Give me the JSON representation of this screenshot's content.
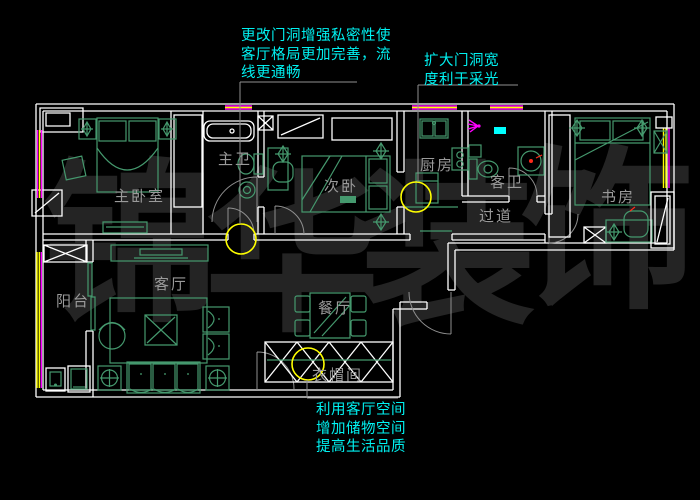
{
  "colors": {
    "background": "#000000",
    "wall": "#ffffff",
    "furniture": "#45996e",
    "annotation": "#00f2f2",
    "label": "#9a9a9a",
    "window_yellow": "#ffff00",
    "window_magenta": "#ff00ff",
    "highlight": "#ffff00",
    "watermark": "#242424",
    "door_arc": "#8f8f8f",
    "accent_red": "#ff2a1a",
    "accent_cyan": "#00ffff"
  },
  "watermark": {
    "text": "锦华装饰",
    "chars": [
      "锦",
      "华",
      "装",
      "饰"
    ]
  },
  "annotations": {
    "top": {
      "lines": [
        "更改门洞增强私密性使",
        "客厅格局更加完善，流",
        "线更通畅"
      ]
    },
    "right": {
      "lines": [
        "扩大门洞宽",
        "度利于采光"
      ]
    },
    "bottom": {
      "lines": [
        "利用客厅空间",
        "增加储物空间",
        "提高生活品质"
      ]
    }
  },
  "rooms": {
    "master_bedroom": "主卧室",
    "master_bath": "主卫",
    "second_bedroom": "次卧",
    "kitchen": "厨房",
    "guest_bath": "客卫",
    "corridor": "过道",
    "study": "书房",
    "balcony": "阳台",
    "living_room": "客厅",
    "dining_room": "餐厅",
    "cloakroom": "衣帽间"
  }
}
